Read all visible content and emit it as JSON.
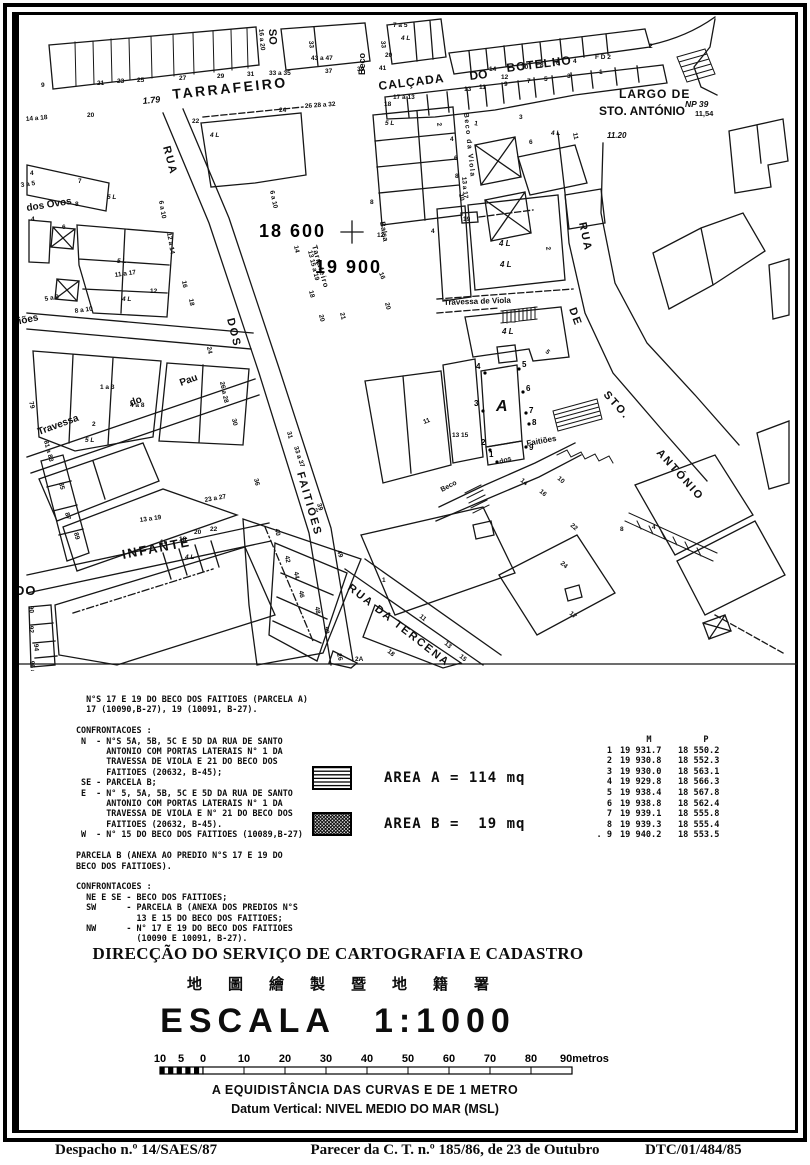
{
  "map": {
    "street_labels": [
      {
        "t": "TARRAFEIRO",
        "x": 160,
        "y": 86,
        "r": -6,
        "s": 14,
        "ls": 2.5
      },
      {
        "t": "1.79",
        "x": 130,
        "y": 91,
        "r": -6,
        "s": 9,
        "it": 1
      },
      {
        "t": "CALÇADA",
        "x": 366,
        "y": 77,
        "r": -7,
        "s": 12,
        "ls": 1
      },
      {
        "t": "DO",
        "x": 457,
        "y": 67,
        "r": -7,
        "s": 12
      },
      {
        "t": "BOTELHO",
        "x": 494,
        "y": 59,
        "r": -7,
        "s": 12,
        "ls": 1
      },
      {
        "t": "LARGO DE",
        "x": 606,
        "y": 85,
        "s": 12,
        "ls": 1
      },
      {
        "t": "STO. ANTÓNIO",
        "x": 586,
        "y": 102,
        "s": 12
      },
      {
        "t": "NP 39",
        "x": 672,
        "y": 94,
        "s": 8.5,
        "it": 1
      },
      {
        "t": "11,54",
        "x": 682,
        "y": 103,
        "s": 7.5
      },
      {
        "t": "11.20",
        "x": 594,
        "y": 125,
        "s": 8,
        "it": 1
      },
      {
        "t": "RUA",
        "x": 566,
        "y": 210,
        "r": 78,
        "s": 11,
        "ls": 2
      },
      {
        "t": "DE",
        "x": 556,
        "y": 296,
        "r": 70,
        "s": 11,
        "ls": 2
      },
      {
        "t": "STO.",
        "x": 590,
        "y": 382,
        "r": 48,
        "s": 11,
        "ls": 2
      },
      {
        "t": "ANTÓNIO",
        "x": 643,
        "y": 440,
        "r": 48,
        "s": 11,
        "ls": 2
      },
      {
        "t": "RUA",
        "x": 150,
        "y": 134,
        "r": 75,
        "s": 11,
        "ls": 2
      },
      {
        "t": "DOS",
        "x": 214,
        "y": 306,
        "r": 76,
        "s": 11,
        "ls": 2
      },
      {
        "t": "FAITIÕES",
        "x": 284,
        "y": 460,
        "r": 74,
        "s": 11,
        "ls": 2
      },
      {
        "t": "dos Ovos",
        "x": 14,
        "y": 198,
        "r": -9,
        "s": 10
      },
      {
        "t": "tiões",
        "x": 3,
        "y": 312,
        "r": -12,
        "s": 10
      },
      {
        "t": "Travessa",
        "x": 26,
        "y": 422,
        "r": -20,
        "s": 10
      },
      {
        "t": "do",
        "x": 118,
        "y": 393,
        "r": -20,
        "s": 10
      },
      {
        "t": "Pau",
        "x": 168,
        "y": 373,
        "r": -20,
        "s": 10
      },
      {
        "t": "INFANTE",
        "x": 110,
        "y": 546,
        "r": -11,
        "s": 13,
        "ls": 2
      },
      {
        "t": "RUA DA TERCENA",
        "x": 334,
        "y": 576,
        "r": 38,
        "s": 11,
        "ls": 2
      },
      {
        "t": "Travessa de Viola",
        "x": 431,
        "y": 292,
        "r": -2,
        "s": 8
      },
      {
        "t": "Beco da Viola",
        "x": 451,
        "y": 100,
        "r": 84,
        "s": 7,
        "ls": 1.5
      },
      {
        "t": "Beco",
        "x": 352,
        "y": 62,
        "r": -90,
        "s": 9
      },
      {
        "t": "SO",
        "x": 256,
        "y": 16,
        "r": 88,
        "s": 11
      },
      {
        "t": "Beco",
        "x": 429,
        "y": 479,
        "r": -28,
        "s": 7
      },
      {
        "t": "dos",
        "x": 487,
        "y": 451,
        "r": -18,
        "s": 7
      },
      {
        "t": "Faitiões",
        "x": 514,
        "y": 433,
        "r": -10,
        "s": 8
      },
      {
        "t": "Tarrafeiro",
        "x": 299,
        "y": 233,
        "r": 74,
        "s": 7.5,
        "ls": 1
      },
      {
        "t": "Balsa",
        "x": 367,
        "y": 209,
        "r": 80,
        "s": 7.5
      },
      {
        "t": "DO",
        "x": 2,
        "y": 582,
        "s": 13,
        "ls": 1
      },
      {
        "t": "A",
        "x": 483,
        "y": 398,
        "s": 16,
        "it": 1
      }
    ],
    "grid_labels": [
      {
        "t": "18 600",
        "x": 246,
        "y": 224
      },
      {
        "t": "19 900",
        "x": 302,
        "y": 260
      }
    ],
    "numbers": [
      {
        "t": "9",
        "x": 28,
        "y": 74
      },
      {
        "t": "21",
        "x": 84,
        "y": 72
      },
      {
        "t": "23",
        "x": 104,
        "y": 70
      },
      {
        "t": "25",
        "x": 124,
        "y": 69
      },
      {
        "t": "27",
        "x": 166,
        "y": 67
      },
      {
        "t": "29",
        "x": 204,
        "y": 65
      },
      {
        "t": "31",
        "x": 234,
        "y": 63
      },
      {
        "t": "33 a 35",
        "x": 256,
        "y": 62
      },
      {
        "t": "37",
        "x": 312,
        "y": 60
      },
      {
        "t": "39",
        "x": 344,
        "y": 58
      },
      {
        "t": "41",
        "x": 366,
        "y": 57
      },
      {
        "t": "16 a 20",
        "x": 246,
        "y": 16,
        "r": 85
      },
      {
        "t": "33",
        "x": 296,
        "y": 28,
        "r": 85
      },
      {
        "t": "43 a 47",
        "x": 298,
        "y": 47
      },
      {
        "t": "7 a 5",
        "x": 380,
        "y": 14
      },
      {
        "t": "33",
        "x": 368,
        "y": 28,
        "r": 85
      },
      {
        "t": "20",
        "x": 372,
        "y": 44
      },
      {
        "t": "4 L",
        "x": 388,
        "y": 27,
        "it": 1
      },
      {
        "t": "14",
        "x": 476,
        "y": 58
      },
      {
        "t": "12",
        "x": 488,
        "y": 66
      },
      {
        "t": "10",
        "x": 508,
        "y": 56
      },
      {
        "t": "8",
        "x": 527,
        "y": 54
      },
      {
        "t": "6",
        "x": 543,
        "y": 52
      },
      {
        "t": "4",
        "x": 560,
        "y": 50
      },
      {
        "t": "F D 2",
        "x": 582,
        "y": 46
      },
      {
        "t": "2",
        "x": 636,
        "y": 35
      },
      {
        "t": "17 a 13",
        "x": 380,
        "y": 86
      },
      {
        "t": "13",
        "x": 451,
        "y": 78
      },
      {
        "t": "11",
        "x": 466,
        "y": 76
      },
      {
        "t": "9",
        "x": 491,
        "y": 73
      },
      {
        "t": "7",
        "x": 514,
        "y": 70
      },
      {
        "t": "5",
        "x": 531,
        "y": 68
      },
      {
        "t": "3",
        "x": 554,
        "y": 65
      },
      {
        "t": "1",
        "x": 586,
        "y": 61
      },
      {
        "t": "2",
        "x": 424,
        "y": 110,
        "r": 80
      },
      {
        "t": "4",
        "x": 437,
        "y": 128
      },
      {
        "t": "6",
        "x": 441,
        "y": 147
      },
      {
        "t": "8",
        "x": 442,
        "y": 165
      },
      {
        "t": "10",
        "x": 446,
        "y": 181,
        "r": 80
      },
      {
        "t": "1",
        "x": 461,
        "y": 112,
        "r": 10
      },
      {
        "t": "3",
        "x": 506,
        "y": 106
      },
      {
        "t": "4 L",
        "x": 538,
        "y": 122,
        "it": 1
      },
      {
        "t": "11",
        "x": 560,
        "y": 120,
        "r": 80
      },
      {
        "t": "6",
        "x": 516,
        "y": 131
      },
      {
        "t": "13 a 17",
        "x": 449,
        "y": 164,
        "r": 85
      },
      {
        "t": "19",
        "x": 450,
        "y": 208
      },
      {
        "t": "4",
        "x": 418,
        "y": 220
      },
      {
        "t": "4 L",
        "x": 486,
        "y": 233,
        "it": 1,
        "s": 8
      },
      {
        "t": "2",
        "x": 533,
        "y": 234,
        "r": 80
      },
      {
        "t": "14 a 18",
        "x": 13,
        "y": 108,
        "r": -5
      },
      {
        "t": "20",
        "x": 74,
        "y": 104
      },
      {
        "t": "22",
        "x": 179,
        "y": 110
      },
      {
        "t": "4 L",
        "x": 197,
        "y": 124,
        "it": 1
      },
      {
        "t": "24",
        "x": 266,
        "y": 99
      },
      {
        "t": "26 28 a 32",
        "x": 292,
        "y": 95,
        "r": -4
      },
      {
        "t": "18",
        "x": 371,
        "y": 93
      },
      {
        "t": "5 L",
        "x": 372,
        "y": 112,
        "it": 1
      },
      {
        "t": "3 a 5",
        "x": 8,
        "y": 174,
        "r": -8
      },
      {
        "t": "7",
        "x": 65,
        "y": 170
      },
      {
        "t": "4",
        "x": 17,
        "y": 162
      },
      {
        "t": "8",
        "x": 62,
        "y": 193
      },
      {
        "t": "4",
        "x": 18,
        "y": 208
      },
      {
        "t": "6",
        "x": 49,
        "y": 216
      },
      {
        "t": "5 L",
        "x": 94,
        "y": 186,
        "it": 1
      },
      {
        "t": "5 L",
        "x": 104,
        "y": 250,
        "it": 1
      },
      {
        "t": "11 a 17",
        "x": 102,
        "y": 264,
        "r": -8
      },
      {
        "t": "4 L",
        "x": 109,
        "y": 288,
        "it": 1
      },
      {
        "t": "12",
        "x": 137,
        "y": 280
      },
      {
        "t": "8 a 10",
        "x": 62,
        "y": 300,
        "r": -8
      },
      {
        "t": "5 a 9",
        "x": 32,
        "y": 288,
        "r": -10
      },
      {
        "t": "12 a 14",
        "x": 154,
        "y": 220,
        "r": 80
      },
      {
        "t": "6 a 10",
        "x": 146,
        "y": 188,
        "r": 80
      },
      {
        "t": "16",
        "x": 169,
        "y": 268,
        "r": 80
      },
      {
        "t": "18",
        "x": 176,
        "y": 286,
        "r": 80
      },
      {
        "t": "6 a 10",
        "x": 257,
        "y": 178,
        "r": 78
      },
      {
        "t": "14",
        "x": 281,
        "y": 233,
        "r": 78
      },
      {
        "t": "13 15 a 19",
        "x": 295,
        "y": 238,
        "r": 76
      },
      {
        "t": "16",
        "x": 366,
        "y": 260,
        "r": 70
      },
      {
        "t": "18",
        "x": 296,
        "y": 278,
        "r": 76
      },
      {
        "t": "20",
        "x": 306,
        "y": 302,
        "r": 76
      },
      {
        "t": "21",
        "x": 327,
        "y": 300,
        "r": 76
      },
      {
        "t": "12",
        "x": 364,
        "y": 224
      },
      {
        "t": "8",
        "x": 357,
        "y": 191
      },
      {
        "t": "20",
        "x": 372,
        "y": 290,
        "r": 76
      },
      {
        "t": "1 a 3",
        "x": 87,
        "y": 376
      },
      {
        "t": "4 a 8",
        "x": 117,
        "y": 394
      },
      {
        "t": "2",
        "x": 79,
        "y": 413
      },
      {
        "t": "79",
        "x": 16,
        "y": 389,
        "r": 75
      },
      {
        "t": "26 a 28",
        "x": 207,
        "y": 369,
        "r": 78
      },
      {
        "t": "30",
        "x": 219,
        "y": 406,
        "r": 78
      },
      {
        "t": "24",
        "x": 194,
        "y": 334,
        "r": 80
      },
      {
        "t": "81 a 83",
        "x": 31,
        "y": 428,
        "r": 75
      },
      {
        "t": "85",
        "x": 46,
        "y": 470,
        "r": 75
      },
      {
        "t": "87",
        "x": 52,
        "y": 500,
        "r": 75
      },
      {
        "t": "89",
        "x": 61,
        "y": 520,
        "r": 75
      },
      {
        "t": "5 L",
        "x": 72,
        "y": 429,
        "it": 1
      },
      {
        "t": "13 a 19",
        "x": 127,
        "y": 509,
        "r": -8
      },
      {
        "t": "23 a 27",
        "x": 192,
        "y": 489,
        "r": -10
      },
      {
        "t": "36",
        "x": 241,
        "y": 466,
        "r": 75
      },
      {
        "t": "31",
        "x": 274,
        "y": 419,
        "r": 75
      },
      {
        "t": "33 a 37",
        "x": 281,
        "y": 434,
        "r": 72
      },
      {
        "t": "39",
        "x": 304,
        "y": 491,
        "r": 72
      },
      {
        "t": "49",
        "x": 324,
        "y": 538,
        "r": 72
      },
      {
        "t": "40",
        "x": 262,
        "y": 516,
        "r": 80
      },
      {
        "t": "42",
        "x": 272,
        "y": 543,
        "r": 80
      },
      {
        "t": "44",
        "x": 281,
        "y": 559,
        "r": 80
      },
      {
        "t": "46",
        "x": 286,
        "y": 578,
        "r": 80
      },
      {
        "t": "48",
        "x": 302,
        "y": 594,
        "r": 80
      },
      {
        "t": "50",
        "x": 311,
        "y": 614,
        "r": 80
      },
      {
        "t": "16",
        "x": 147,
        "y": 531
      },
      {
        "t": "18",
        "x": 166,
        "y": 528
      },
      {
        "t": "20",
        "x": 181,
        "y": 521
      },
      {
        "t": "22",
        "x": 197,
        "y": 518
      },
      {
        "t": "4 L",
        "x": 172,
        "y": 546,
        "it": 1
      },
      {
        "t": "90",
        "x": 16,
        "y": 593,
        "r": 85
      },
      {
        "t": "92",
        "x": 16,
        "y": 613,
        "r": 85
      },
      {
        "t": "94",
        "x": 21,
        "y": 631,
        "r": 85
      },
      {
        "t": "96 a",
        "x": 17,
        "y": 648,
        "r": 85
      },
      {
        "t": "1",
        "x": 369,
        "y": 569
      },
      {
        "t": "11",
        "x": 406,
        "y": 604,
        "r": 40
      },
      {
        "t": "13",
        "x": 431,
        "y": 631,
        "r": 40
      },
      {
        "t": "15",
        "x": 446,
        "y": 644,
        "r": 40
      },
      {
        "t": "22",
        "x": 557,
        "y": 513,
        "r": 40
      },
      {
        "t": "24",
        "x": 547,
        "y": 551,
        "r": 40
      },
      {
        "t": "17",
        "x": 556,
        "y": 601,
        "r": 40
      },
      {
        "t": "8",
        "x": 607,
        "y": 518
      },
      {
        "t": "4",
        "x": 639,
        "y": 516
      },
      {
        "t": "26",
        "x": 324,
        "y": 641,
        "r": 75
      },
      {
        "t": "2A",
        "x": 342,
        "y": 648
      },
      {
        "t": "18",
        "x": 374,
        "y": 639,
        "r": 40
      },
      {
        "t": "13 15",
        "x": 439,
        "y": 424
      },
      {
        "t": "11",
        "x": 411,
        "y": 411,
        "r": -20
      },
      {
        "t": "14",
        "x": 507,
        "y": 468,
        "r": 40
      },
      {
        "t": "16",
        "x": 526,
        "y": 479,
        "r": 40
      },
      {
        "t": "10",
        "x": 544,
        "y": 466,
        "r": 40
      },
      {
        "t": "4 L",
        "x": 489,
        "y": 321,
        "it": 1,
        "s": 8
      },
      {
        "t": "5",
        "x": 532,
        "y": 339,
        "r": 45
      },
      {
        "t": "4 L",
        "x": 487,
        "y": 254,
        "it": 1,
        "s": 8
      }
    ],
    "survey_points": [
      {
        "n": "1",
        "dx": 484,
        "dy": 449,
        "lx": 476,
        "ly": 444
      },
      {
        "n": "2",
        "dx": 477,
        "dy": 437,
        "lx": 468,
        "ly": 432
      },
      {
        "n": "3",
        "dx": 470,
        "dy": 398,
        "lx": 461,
        "ly": 393
      },
      {
        "n": "4",
        "dx": 472,
        "dy": 360,
        "lx": 463,
        "ly": 356
      },
      {
        "n": "5",
        "dx": 506,
        "dy": 356,
        "lx": 509,
        "ly": 354
      },
      {
        "n": "6",
        "dx": 510,
        "dy": 379,
        "lx": 513,
        "ly": 378
      },
      {
        "n": "7",
        "dx": 513,
        "dy": 400,
        "lx": 516,
        "ly": 400
      },
      {
        "n": "8",
        "dx": 516,
        "dy": 411,
        "lx": 519,
        "ly": 412
      },
      {
        "n": "9",
        "dx": 513,
        "dy": 434,
        "lx": 516,
        "ly": 437
      }
    ]
  },
  "notes": {
    "text": "  N°S 17 E 19 DO BECO DOS FAITIOES (PARCELA A)\n  17 (10090,B-27), 19 (10091, B-27).\n\nCONFRONTACOES :\n N  - N°S 5A, 5B, 5C E 5D DA RUA DE SANTO\n      ANTONIO COM PORTAS LATERAIS N° 1 DA\n      TRAVESSA DE VIOLA E 21 DO BECO DOS\n      FAITIOES (20632, B-45);\n SE - PARCELA B;\n E  - N° 5, 5A, 5B, 5C E 5D DA RUA DE SANTO\n      ANTONIO COM PORTAS LATERAIS N° 1 DA\n      TRAVESSA DE VIOLA E N° 21 DO BECO DOS\n      FAITIOES (20632, B-45).\n W  - N° 15 DO BECO DOS FAITIOES (10089,B-27)\n\nPARCELA B (ANEXA AO PREDIO N°S 17 E 19 DO\nBECO DOS FAITIOES).\n\nCONFRONTACOES :\n  NE E SE - BECO DOS FAITIOES;\n  SW      - PARCELA B (ANEXA DOS PREDIOS N°S\n            13 E 15 DO BECO DOS FAITIOES;\n  NW      - N° 17 E 19 DO BECO DOS FAITIOES\n            (10090 E 10091, B-27)."
  },
  "legend": {
    "items": [
      {
        "swatch": "horizontal-hatch",
        "label": "AREA A = 114 mq"
      },
      {
        "swatch": "crosshatch",
        "label": "AREA B =  19 mq"
      }
    ]
  },
  "coords_table": {
    "headers": [
      "M",
      "P"
    ],
    "rows": [
      [
        "1",
        "19 931.7",
        "18 550.2"
      ],
      [
        "2",
        "19 930.8",
        "18 552.3"
      ],
      [
        "3",
        "19 930.0",
        "18 563.1"
      ],
      [
        "4",
        "19 929.8",
        "18 566.3"
      ],
      [
        "5",
        "19 938.4",
        "18 567.8"
      ],
      [
        "6",
        "19 938.8",
        "18 562.4"
      ],
      [
        "7",
        "19 939.1",
        "18 555.8"
      ],
      [
        "8",
        "19 939.3",
        "18 555.4"
      ],
      [
        ". 9",
        "19 940.2",
        "18 553.5"
      ]
    ]
  },
  "title_block": {
    "org_pt": "DIRECÇÃO DO SERVIÇO DE CARTOGRAFIA E CADASTRO",
    "org_zh": "地圖繪製暨地籍署",
    "escala_label": "ESCALA",
    "escala_value": "1:1000"
  },
  "scale_bar": {
    "ticks": [
      "10",
      "5",
      "0",
      "10",
      "20",
      "30",
      "40",
      "50",
      "60",
      "70",
      "80"
    ],
    "end_label": "90metros",
    "note1": "A EQUIDISTÂNCIA DAS CURVAS E DE 1 METRO",
    "note2": "Datum Vertical: NIVEL MEDIO DO MAR (MSL)"
  },
  "footer": {
    "left": "Despacho n.º 14/SAES/87",
    "center": "Parecer da C. T. n.º 185/86, de 23 de Outubro",
    "right": "DTC/01/484/85"
  },
  "colors": {
    "ink": "#0d0d0d",
    "paper": "#ffffff"
  }
}
